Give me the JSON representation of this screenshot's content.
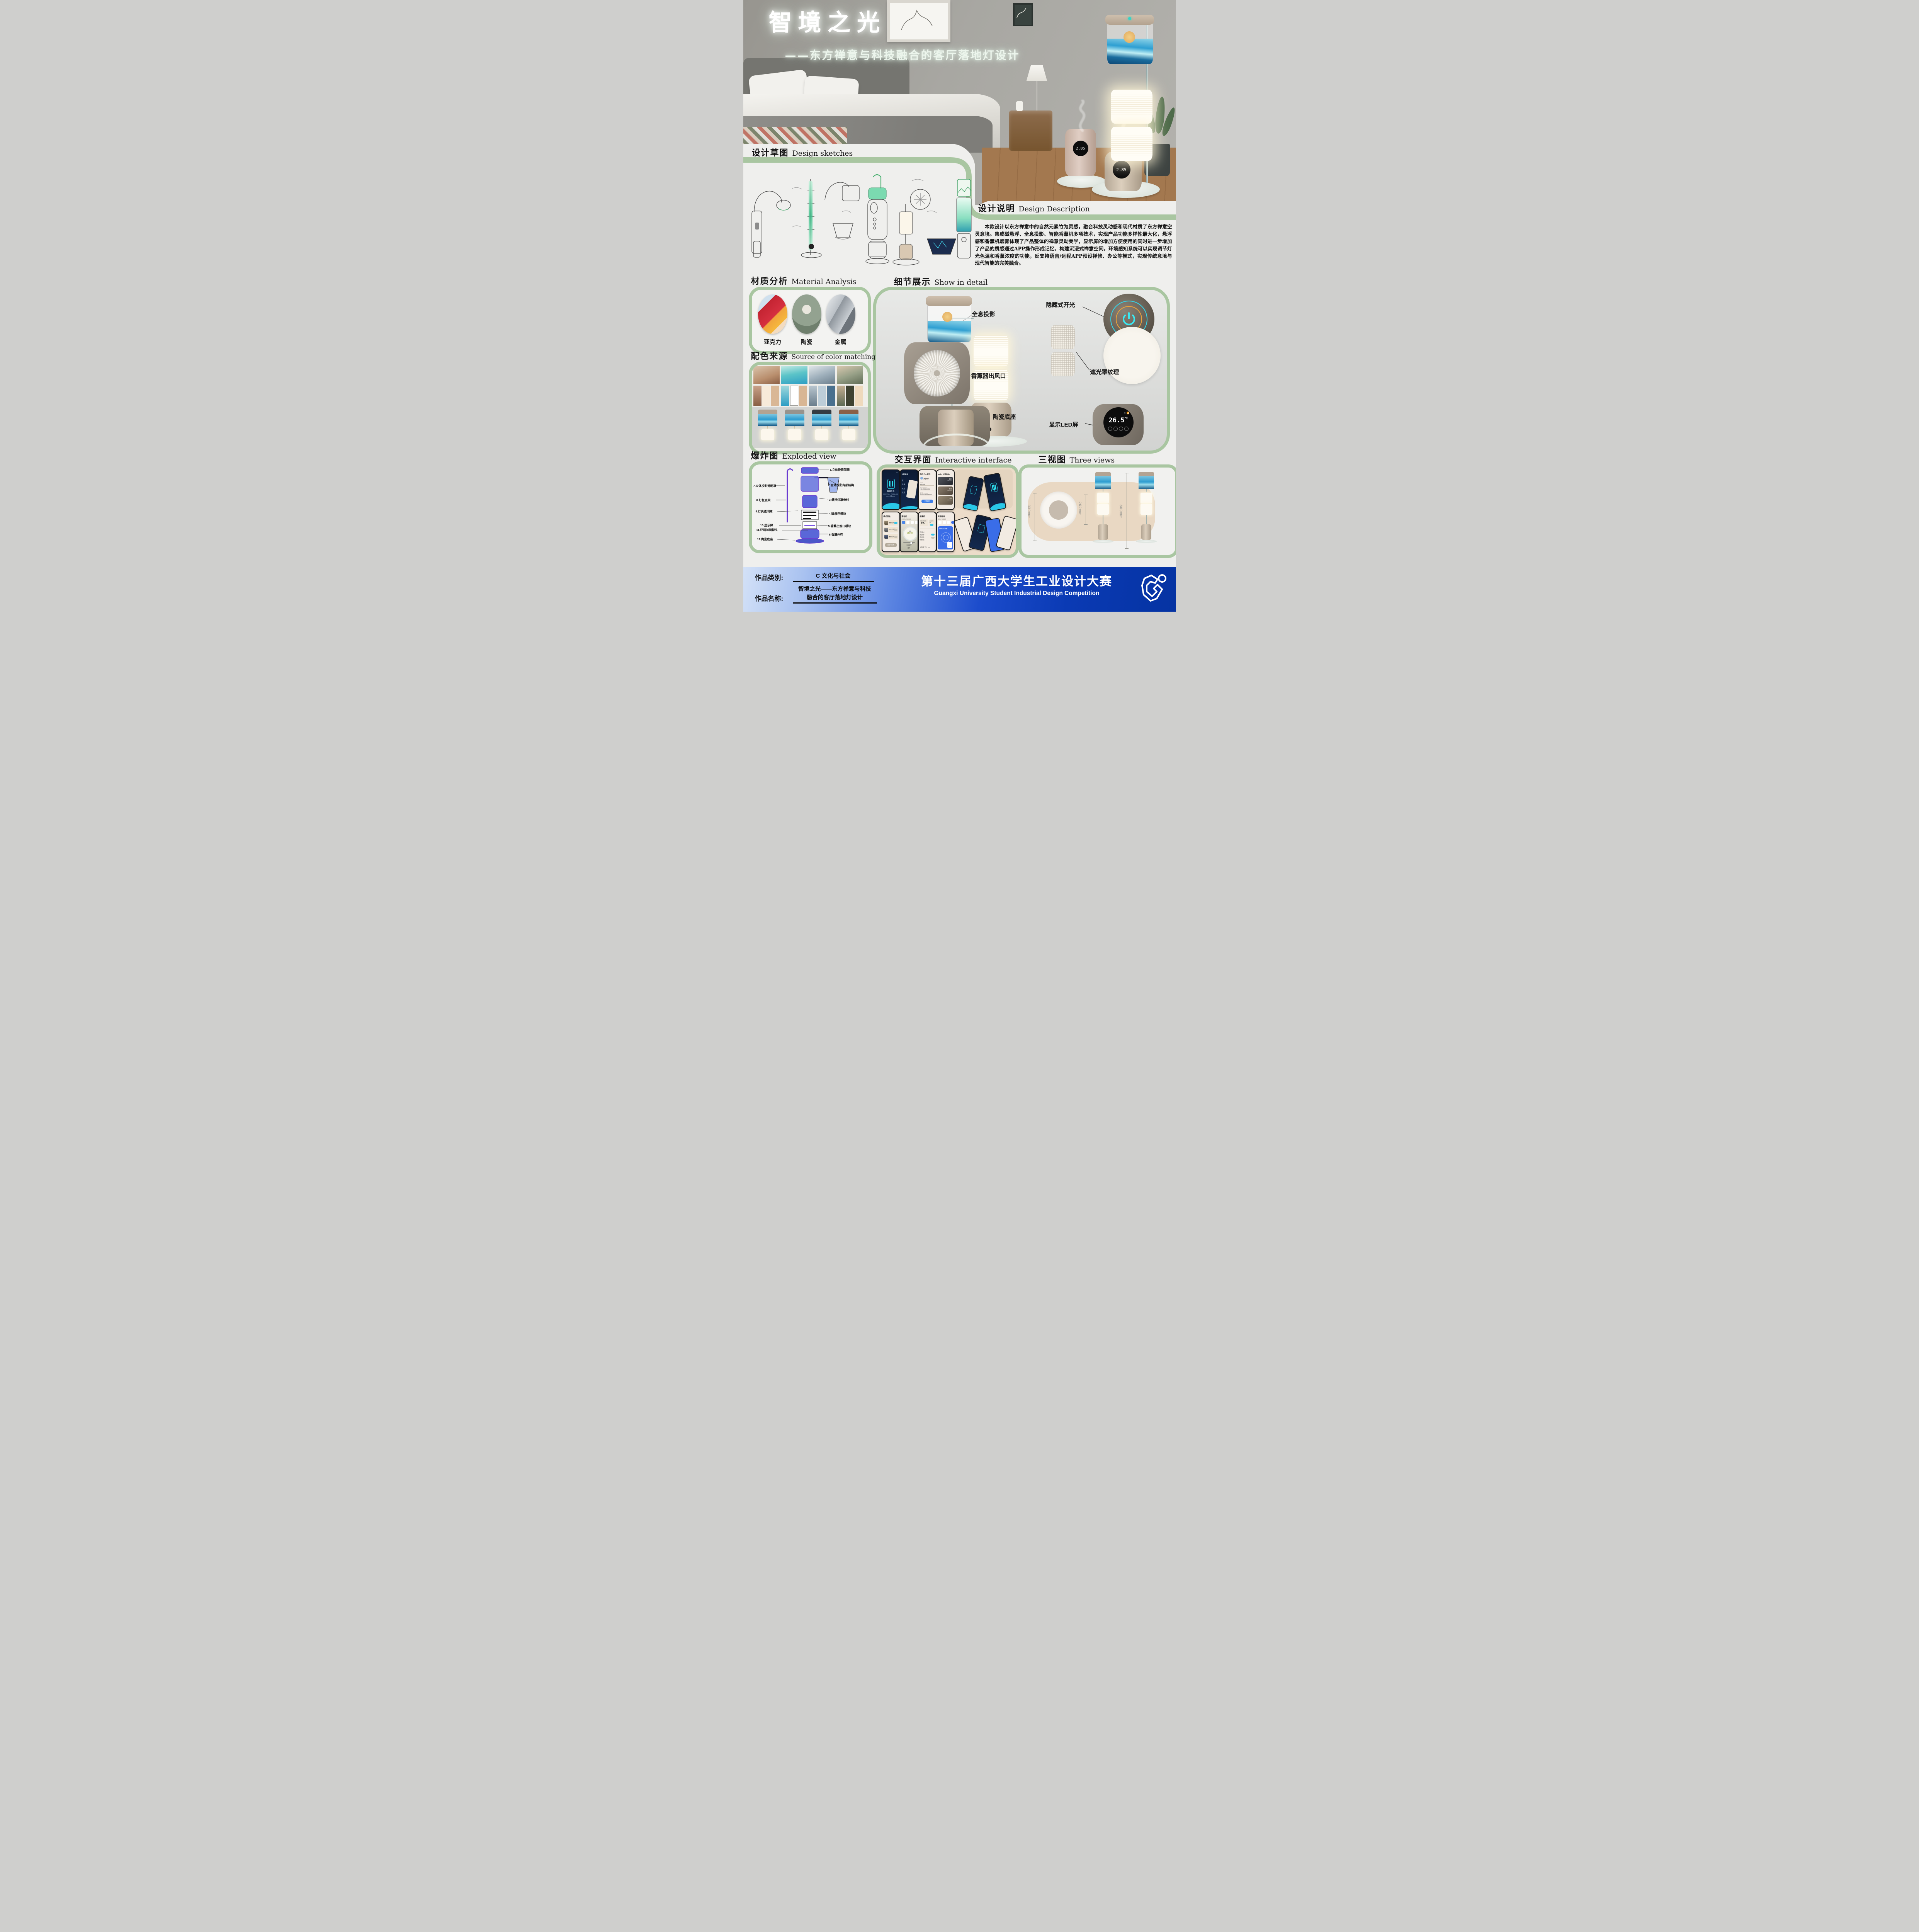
{
  "poster": {
    "title": "智境之光",
    "subtitle": "——东方禅意与科技融合的客厅落地灯设计"
  },
  "sections": {
    "sketches": {
      "zh": "设计草图",
      "en": "Design sketches"
    },
    "description": {
      "zh": "设计说明",
      "en": "Design Description",
      "body": "本款设计以东方禅意中的自然元素竹为灵感，融合科技灵动感和现代材质了东方禅意空灵意境。集成磁悬浮、全息投影、智能香薰机多项技术，实现产品功能多样性最大化，悬浮感和香薰机烟雾体现了产品整体的禅意灵动美学，显示屏的增加方便使用的同时进一步增加了产品的质感通过APP操作形成记忆，构建沉浸式禅意空间，环境感知系统可以实现调节灯光色温和香薰浓度的功能，反支持语音/远程APP预设禅修、办公等模式，实现传统意境与现代智能的完美融合。"
    },
    "materials": {
      "zh": "材质分析",
      "en": "Material Analysis",
      "items": [
        "亚克力",
        "陶瓷",
        "金属"
      ]
    },
    "colors": {
      "zh": "配色来源",
      "en": "Source of color matching",
      "swatches": [
        [
          "#f7ead9",
          "#d9b795"
        ],
        [
          "#ffffff",
          "#d8b694"
        ],
        [
          "#bccdd8",
          "#49708e"
        ],
        [
          "#3f4231",
          "#eed9bd"
        ]
      ]
    },
    "details": {
      "zh": "细节展示",
      "en": "Show in detail",
      "labels": [
        "全息投影",
        "隐藏式开光",
        "香薰器出风口",
        "遮光罩纹理",
        "陶瓷底座",
        "显示LED屏"
      ],
      "led_value": "26.5",
      "led_unit": "℃"
    },
    "exploded": {
      "zh": "爆炸图",
      "en": "Exploded view",
      "parts": [
        "1.立体投影顶盖",
        "2.立体投影内部结构",
        "3.悬挂灯罩电线",
        "4.磁悬浮模块",
        "5.香薰出烟口模块",
        "6.香薰外壳",
        "7.立体投影透明罩",
        "8.灯杠支架",
        "9.灯具透明罩",
        "10.显示屏",
        "11.环境监测探头",
        "12.陶瓷底座"
      ]
    },
    "interface": {
      "zh": "交互界面",
      "en": "Interactive interface"
    },
    "views": {
      "zh": "三视图",
      "en": "Three views",
      "dims": [
        "330mm",
        "262mm",
        "800mm"
      ]
    }
  },
  "hero": {
    "display_value": "2.85"
  },
  "app": {
    "splash": {
      "skip": "SKIP",
      "name": "智镜之光",
      "tagline1": "您只需要滑动一下就能进入智能家居",
      "tagline2": "禅意与科技的世界"
    },
    "menu": {
      "user": "大猛同学",
      "item1": "家",
      "item2": "设备",
      "item3": "成员",
      "item4": "设置"
    },
    "profile": {
      "title": "我的个人资料",
      "name": "大猛同学",
      "field1": "Name",
      "value1": "大猛同学",
      "field2": "Phone Number",
      "value2": "+98-19698612368",
      "field3": "Email",
      "value3": "2840541880@qq.com",
      "button": "完成编辑"
    },
    "home": {
      "greeting": "Hello, 大猛同学!",
      "room1": "客厅",
      "room2": "卧室",
      "room3": "书房",
      "devices": "4 Devices"
    },
    "modes": {
      "title": "模式预设",
      "item1": "禅修模式",
      "item2": "办公/学习模式",
      "item3": "娱乐模式",
      "button": "自定义设置"
    },
    "lamp": {
      "title": "落地灯",
      "sub": "总共有4个源器件",
      "dial_label": "色温",
      "dial_value": "3500K",
      "slider": "亮度调节",
      "auto": "自动"
    },
    "aroma": {
      "title": "香薰机",
      "air_label": "室内空气质量",
      "air_value": "80",
      "air_unit": "%",
      "switch_label": "设备开关",
      "on": "ON",
      "mist_label": "今日喷雾（次）",
      "mist_value": "80"
    },
    "devices": {
      "title": "有源器件",
      "sub": "共有4个源器件",
      "search": "搜索附近的设备...",
      "cam": "Mi Cam"
    }
  },
  "footer": {
    "category_label": "作品类别:",
    "category_value": "C  文化与社会",
    "name_label": "作品名称:",
    "name_line1": "智境之光——东方禅意与科技",
    "name_line2": "融合的客厅落地灯设计",
    "competition_zh": "第十三届广西大学生工业设计大赛",
    "competition_en": "Guangxi University Student Industrial Design Competition"
  },
  "accents": {
    "green": "#a9c6a1",
    "deep_blue": "#0a3ab4",
    "teal": "#29c8e8",
    "led_black": "#0c0c0c"
  }
}
